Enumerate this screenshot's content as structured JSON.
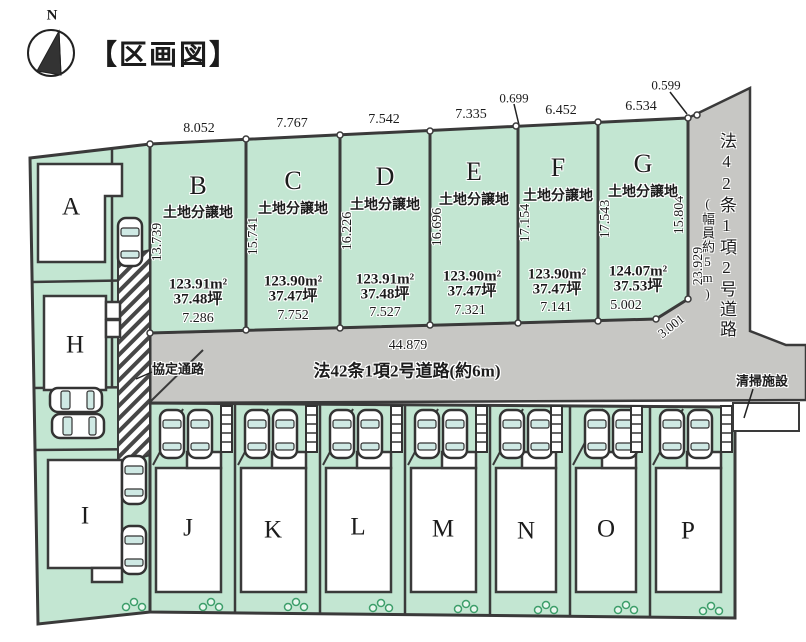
{
  "title": "【区画図】",
  "compass": {
    "north_label": "N"
  },
  "top_plots": [
    {
      "letter": "B",
      "category": "土地分譲地",
      "top_width": "8.052",
      "side": "13.739",
      "area_m2": "123.91m²",
      "area_tsubo": "37.48坪",
      "bottom_width": "7.286"
    },
    {
      "letter": "C",
      "category": "土地分譲地",
      "top_width": "7.767",
      "side": "15.741",
      "area_m2": "123.90m²",
      "area_tsubo": "37.47坪",
      "bottom_width": "7.752"
    },
    {
      "letter": "D",
      "category": "土地分譲地",
      "top_width": "7.542",
      "side": "16.226",
      "area_m2": "123.91m²",
      "area_tsubo": "37.48坪",
      "bottom_width": "7.527"
    },
    {
      "letter": "E",
      "category": "土地分譲地",
      "top_width": "7.335",
      "side": "16.696",
      "area_m2": "123.90m²",
      "area_tsubo": "37.47坪",
      "bottom_width": "7.321"
    },
    {
      "letter": "F",
      "category": "土地分譲地",
      "top_width": "6.452",
      "side": "17.154",
      "area_m2": "123.90m²",
      "area_tsubo": "37.47坪",
      "bottom_width": "7.141"
    },
    {
      "letter": "G",
      "category": "土地分譲地",
      "top_width": "6.534",
      "side": "17.543",
      "right_side": "15.804",
      "area_m2": "124.07m²",
      "area_tsubo": "37.53坪",
      "bottom_width": "5.002",
      "corner": "3.001"
    }
  ],
  "jog_labels": {
    "e_f_top": "0.699",
    "g_road_top": "0.599"
  },
  "left_plots": {
    "a": "A",
    "h": "H",
    "i": "I"
  },
  "bottom_plots": [
    "J",
    "K",
    "L",
    "M",
    "N",
    "O",
    "P"
  ],
  "center_road": {
    "total_length": "44.879",
    "name": "法42条1項2号道路(約6m)"
  },
  "right_road": {
    "name": "法42条1項2号道路",
    "width_note": "(幅員約5m)",
    "length": "23.929"
  },
  "passage_label": "協定通路",
  "cleaning_label": "清掃施設",
  "colors": {
    "plot_green": "#c3e6d2",
    "road_gray": "#c7c7c4",
    "line": "#3a3a3a"
  }
}
